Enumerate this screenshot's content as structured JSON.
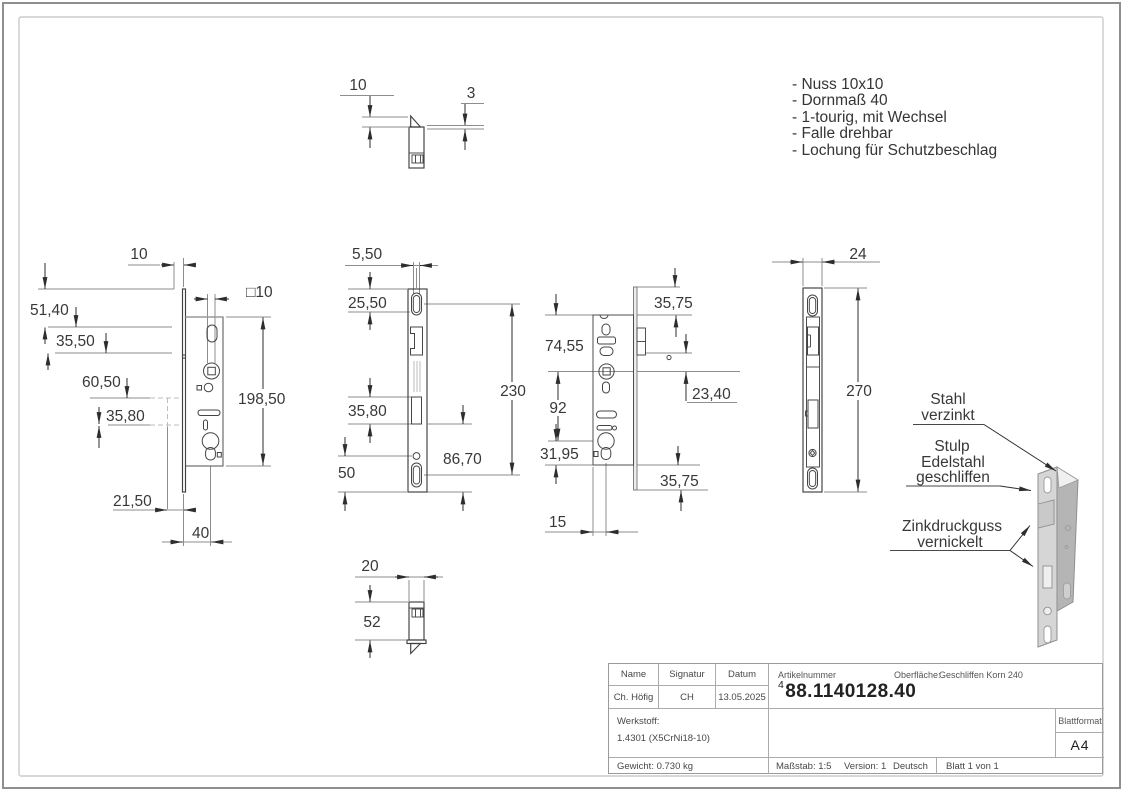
{
  "notes": {
    "items": [
      "- Nuss 10x10",
      "- Dornmaß 40",
      "- 1-tourig, mit Wechsel",
      "- Falle drehbar",
      "- Lochung für Schutzbeschlag"
    ]
  },
  "dims": {
    "top_view": {
      "gap": "10",
      "thickness": "3"
    },
    "bottom_view": {
      "width": "20",
      "depth": "52"
    },
    "side_view": {
      "offset": "10",
      "square_nut": "□10",
      "a": "51,40",
      "b": "35,50",
      "c": "60,50",
      "d": "35,80",
      "case_height": "198,50",
      "e": "21,50",
      "backset": "40"
    },
    "plate_view": {
      "slot_width": "5,50",
      "a": "25,50",
      "b": "35,80",
      "c": "50",
      "height": "230",
      "d": "86,70"
    },
    "rear_view": {
      "top_offset": "35,75",
      "a": "74,55",
      "b": "23,40",
      "c": "92",
      "d": "31,95",
      "bottom_offset": "35,75",
      "e": "15"
    },
    "stulp_view": {
      "width": "24",
      "height": "270"
    }
  },
  "callouts": {
    "steel": {
      "line1": "Stahl",
      "line2": "verzinkt"
    },
    "stulp": {
      "line1": "Stulp",
      "line2": "Edelstahl",
      "line3": "geschliffen"
    },
    "zinc": {
      "line1": "Zinkdruckguss",
      "line2": "vernickelt"
    }
  },
  "title_block": {
    "name_label": "Name",
    "signature_label": "Signatur",
    "date_label": "Datum",
    "name": "Ch. Höfig",
    "signature": "CH",
    "date": "13.05.2025",
    "article_label": "Artikelnummer",
    "article_sup": "4",
    "article_number": "88.1140128.40",
    "surface_label": "Oberfläche:",
    "surface_value": "Geschliffen Korn 240",
    "material_label": "Werkstoff:",
    "material_value": "1.4301  (X5CrNi18-10)",
    "weight": "Gewicht: 0.730 kg",
    "scale": "Maßstab: 1:5",
    "version": "Version: 1",
    "language": "Deutsch",
    "sheet": "Blatt 1 von 1",
    "format_label": "Blattformat",
    "format_value": "A4"
  },
  "colors": {
    "outline": "#3f3f3f",
    "dimension": "#8d8d8d",
    "steel_gray": "#b5b5b5"
  }
}
